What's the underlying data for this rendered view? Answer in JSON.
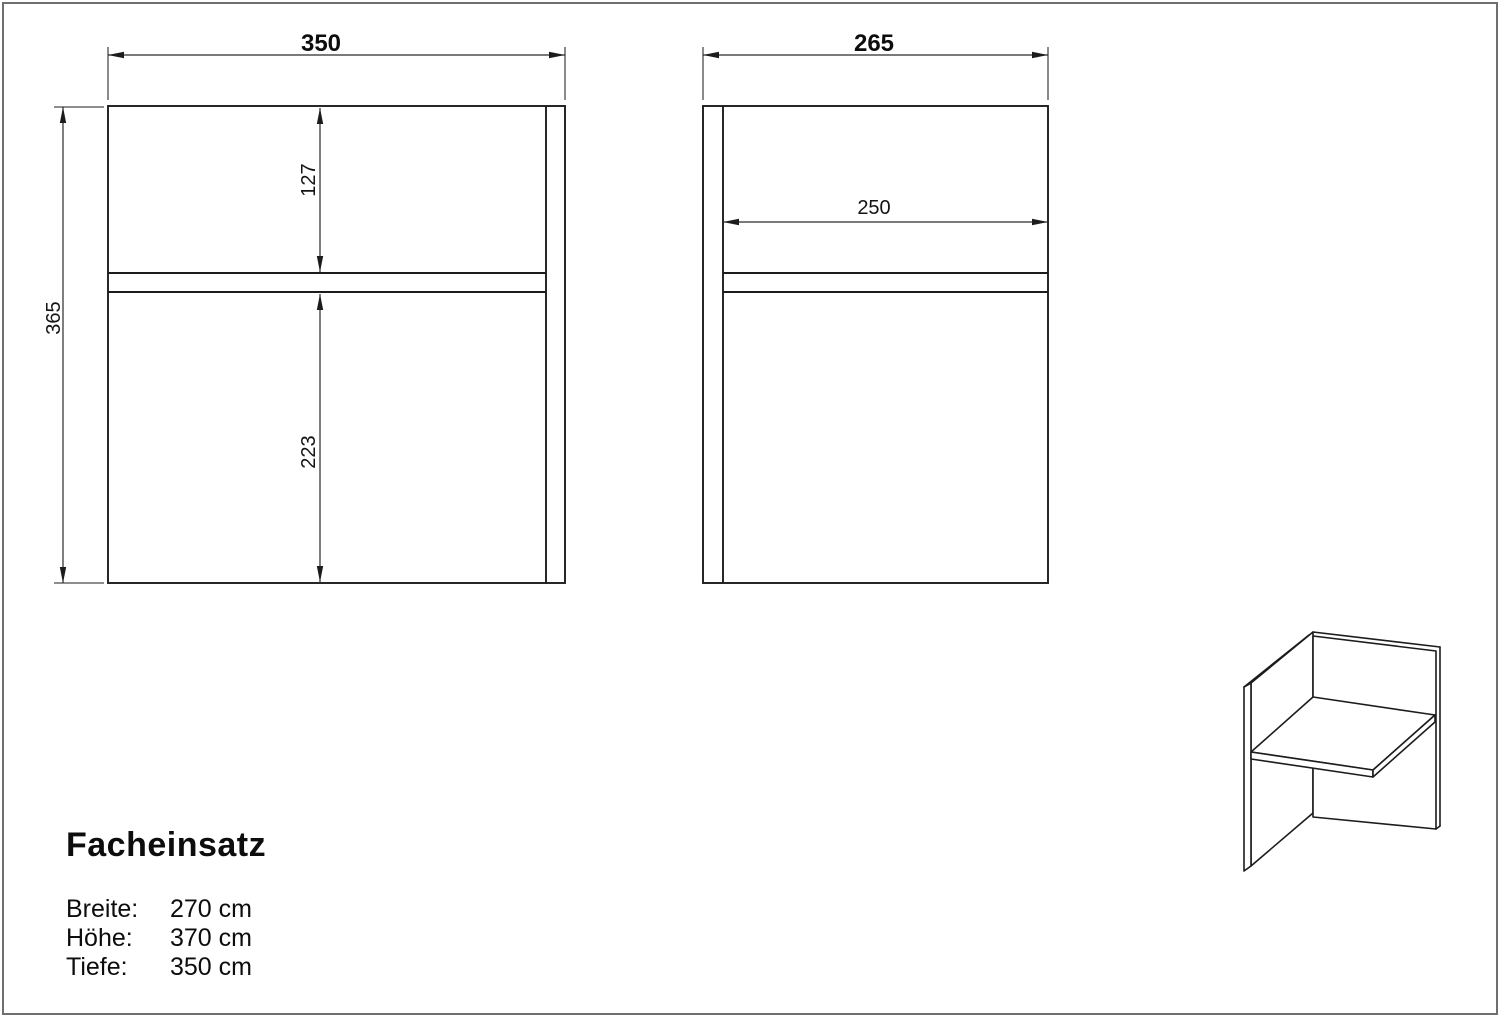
{
  "page": {
    "background": "#ffffff",
    "border_color": "#6f6f6f",
    "line_color": "#1c1c1c"
  },
  "front_view": {
    "width_dim": "350",
    "height_dim": "365",
    "upper_compartment_dim": "127",
    "lower_compartment_dim": "223"
  },
  "side_view": {
    "width_dim": "265",
    "inner_depth_dim": "250"
  },
  "product": {
    "title": "Facheinsatz",
    "specs": [
      {
        "label": "Breite:",
        "value": "270 cm"
      },
      {
        "label": "Höhe:",
        "value": "370 cm"
      },
      {
        "label": "Tiefe:",
        "value": "350 cm"
      }
    ]
  }
}
